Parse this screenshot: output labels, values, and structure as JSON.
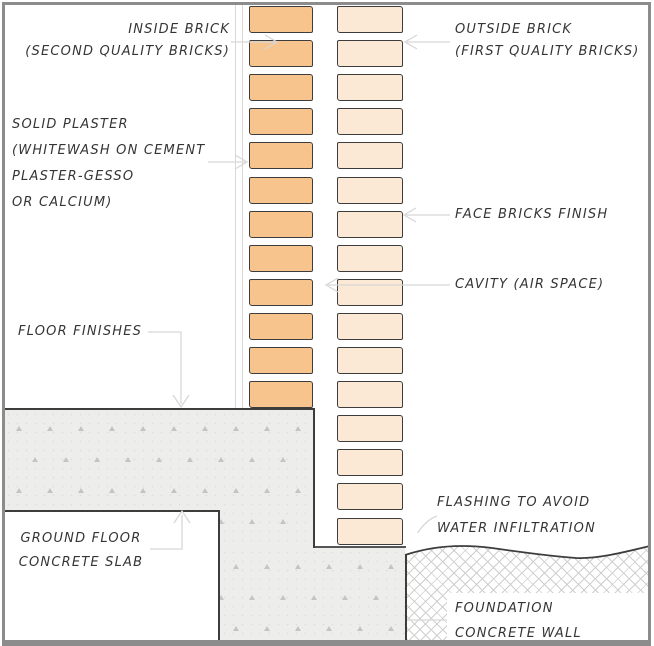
{
  "title": "Cavity wall construction detail",
  "colors": {
    "frame": "#8C8C8C",
    "dark": "#3D3D3D",
    "leader": "#D7D7D7",
    "inner_brick": "#F7C48D",
    "outer_brick": "#FBE8D5",
    "slab": "#EDEEEC",
    "text": "#353535",
    "hatch": "#CFCFCF",
    "tri": "#C2C6C2"
  },
  "structure": {
    "inner_brick_count": 12,
    "outer_brick_count": 16
  },
  "labels": {
    "inside_brick": {
      "line1": "INSIDE BRICK",
      "line2": "(SECOND QUALITY BRICKS)"
    },
    "outside_brick": {
      "line1": "OUTSIDE BRICK",
      "line2": "(FIRST QUALITY BRICKS)"
    },
    "solid_plaster": {
      "line1": "SOLID PLASTER",
      "line2": "(WHITEWASH ON CEMENT",
      "line3": "PLASTER-GESSO",
      "line4": "OR CALCIUM)"
    },
    "face_bricks": {
      "line1": "FACE BRICKS FINISH"
    },
    "cavity": {
      "line1": "CAVITY (AIR SPACE)"
    },
    "floor_finishes": {
      "line1": "FLOOR FINISHES"
    },
    "ground_floor": {
      "line1": "GROUND FLOOR",
      "line2": "CONCRETE SLAB"
    },
    "flashing": {
      "line1": "FLASHING TO AVOID",
      "line2": "WATER INFILTRATION"
    },
    "foundation": {
      "line1": "FOUNDATION",
      "line2": "CONCRETE WALL"
    }
  }
}
